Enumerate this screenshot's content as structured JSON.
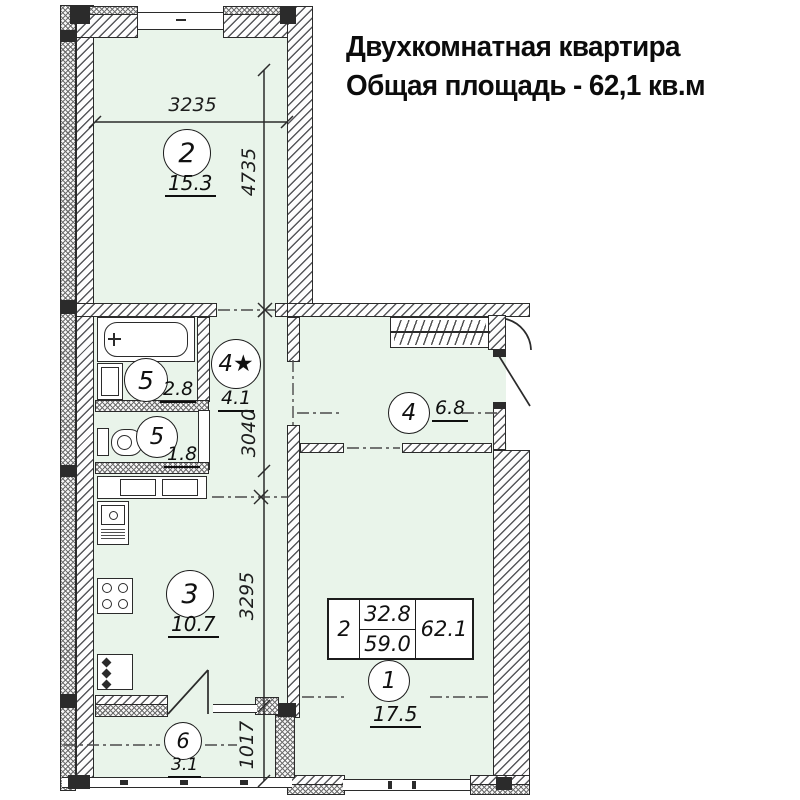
{
  "title": {
    "line1": "Двухкомнатная квартира",
    "line2": "Общая площадь - 62,1 кв.м"
  },
  "rooms": [
    {
      "number": "2",
      "area": "15.3"
    },
    {
      "number": "5",
      "area": "2.8"
    },
    {
      "number": "4★",
      "area": "4.1"
    },
    {
      "number": "5",
      "area": "1.8"
    },
    {
      "number": "4",
      "area": "6.8"
    },
    {
      "number": "3",
      "area": "10.7"
    },
    {
      "number": "1",
      "area": "17.5"
    },
    {
      "number": "6",
      "area": "3.1"
    }
  ],
  "dimensions": {
    "room2_width": "3235",
    "room2_height": "4735",
    "hall_height": "3040",
    "kitchen_height": "3295",
    "balcony_height": "1017"
  },
  "area_table": {
    "rooms_count": "2",
    "living_area": "32.8",
    "reduced_area": "59.0",
    "total_area": "62.1"
  },
  "colors": {
    "room_fill": "#e9f4ea",
    "line": "#2b2b2b"
  }
}
